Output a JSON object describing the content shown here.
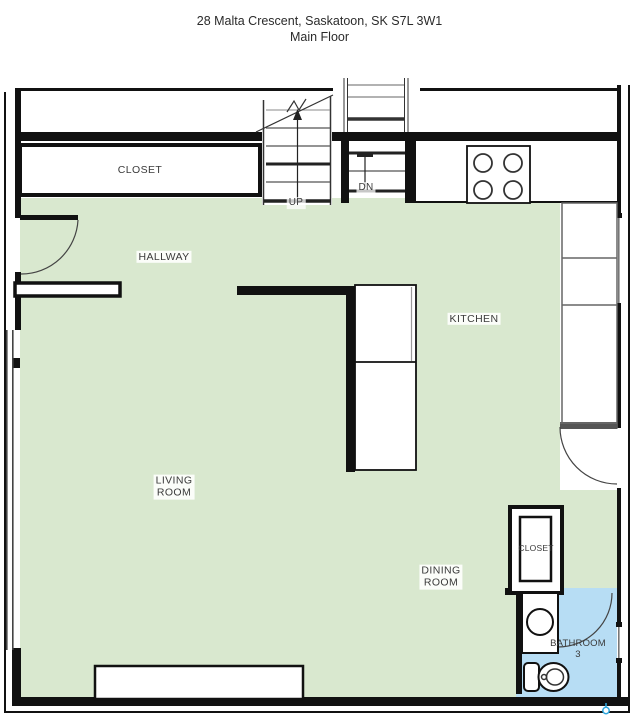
{
  "title": {
    "address": "28 Malta Crescent, Saskatoon, SK S7L 3W1",
    "floor": "Main Floor"
  },
  "labels": {
    "closet_top": "CLOSET",
    "hallway": "HALLWAY",
    "kitchen": "KITCHEN",
    "living_room_line1": "LIVING",
    "living_room_line2": "ROOM",
    "dining_room_line1": "DINING",
    "dining_room_line2": "ROOM",
    "closet_bottom": "CLOSET",
    "bathroom_line1": "BATHROOM",
    "bathroom_line2": "3",
    "stairs_up": "UP",
    "stairs_down": "DN"
  },
  "colors": {
    "floor_green": "#d9e8cf",
    "bathroom_blue": "#b7ddf4",
    "wall": "#111111",
    "marker_blue": "#2ea7df"
  }
}
